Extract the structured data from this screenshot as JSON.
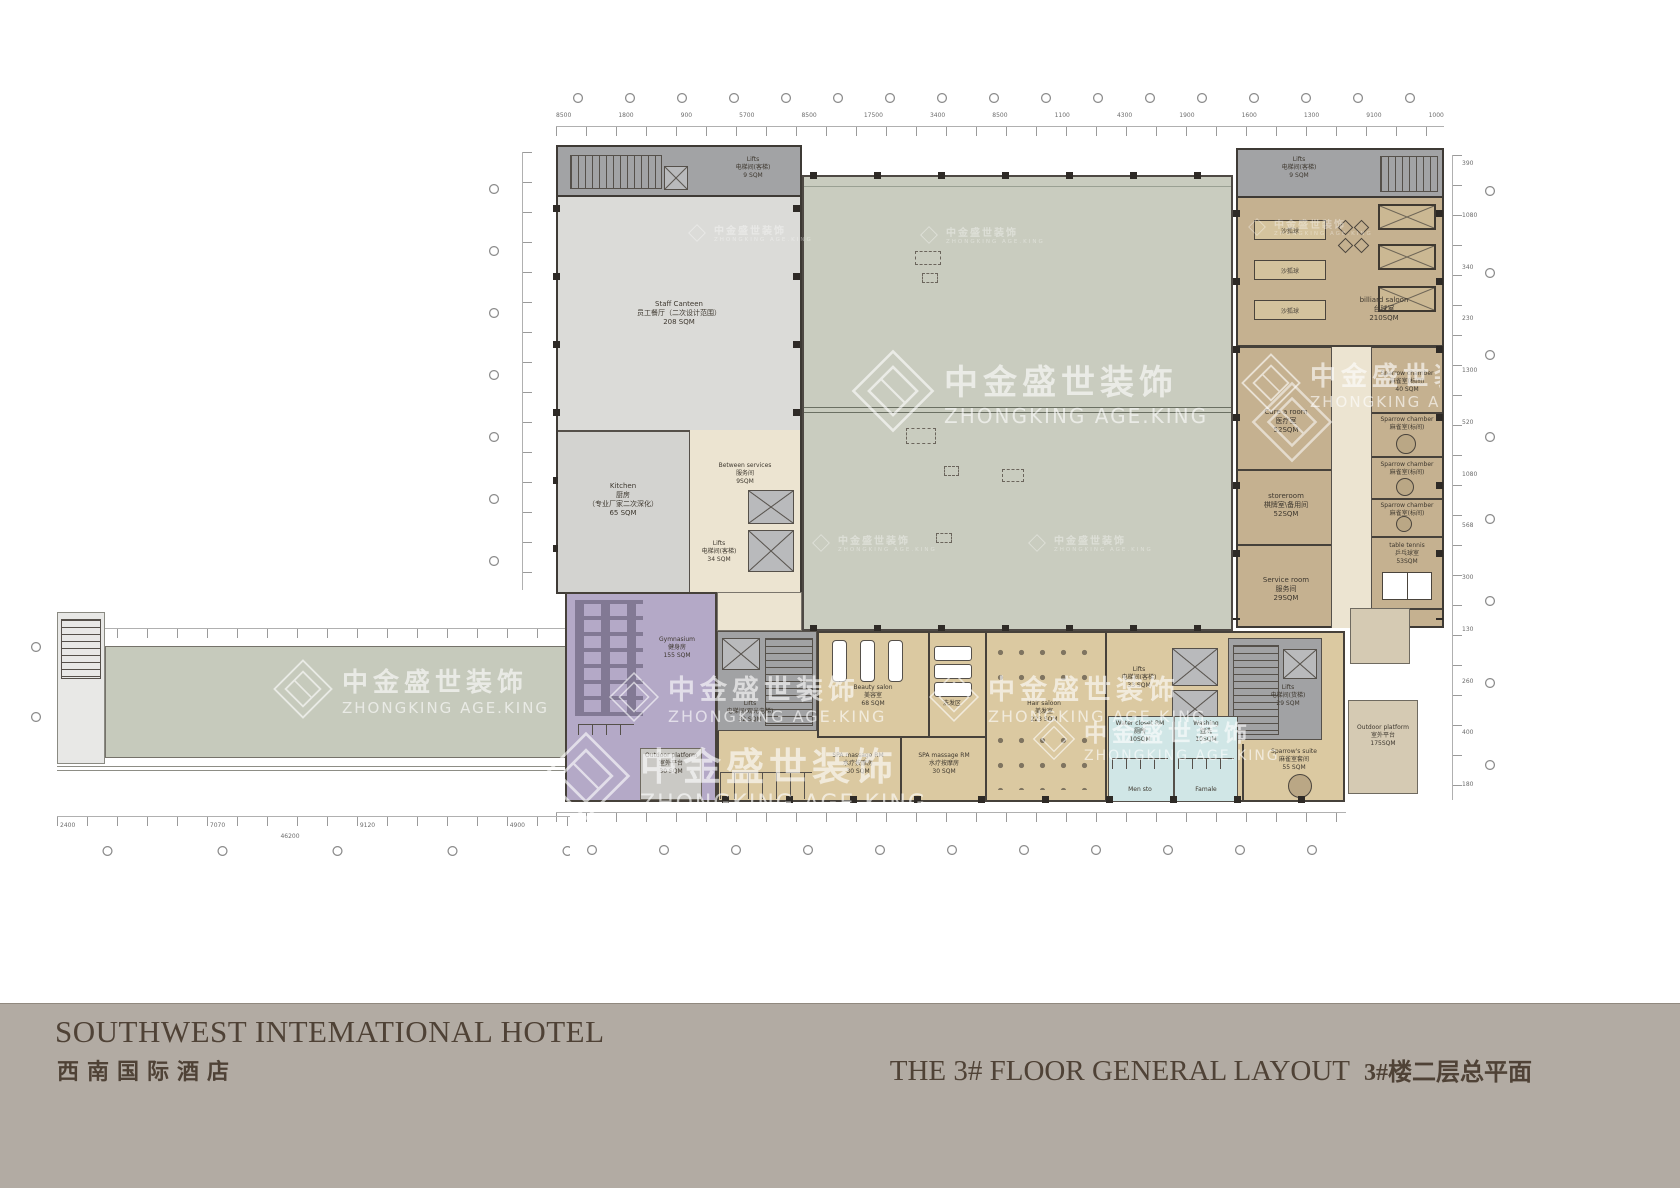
{
  "watermark": {
    "cn": "中金盛世装饰",
    "en": "ZHONGKING AGE.KING"
  },
  "footer": {
    "hotel_en": "SOUTHWEST INTEMATIONAL HOTEL",
    "hotel_cn": "西南国际酒店",
    "layout_en": "THE 3# FLOOR GENERAL LAYOUT",
    "layout_cn": "3#楼二层总平面"
  },
  "rooms": {
    "staff_canteen": {
      "en": "Staff Canteen",
      "cn": "员工餐厅（二次设计范围）",
      "area": "208 SQM"
    },
    "kitchen": {
      "en": "Kitchen",
      "cn": "厨房",
      "note": "（专业厂家二次深化）",
      "area": "65 SQM"
    },
    "between_services": {
      "en": "Between services",
      "cn": "服务间",
      "area": "9SQM"
    },
    "lifts_canteen": {
      "en": "Lifts",
      "cn": "电梯间(客梯)",
      "area": "34 SQM"
    },
    "lifts_small": {
      "en": "Lifts",
      "cn": "电梯间(客梯)",
      "area": "9 SQM"
    },
    "billiard": {
      "en": "billiard saloon",
      "cn": "台球室",
      "area": "210SQM"
    },
    "cure_room": {
      "en": "Cure a room",
      "cn": "医疗室",
      "area": "52SQM"
    },
    "storeroom": {
      "en": "storeroom",
      "cn": "棋牌室\\备用间",
      "area": "52SQM"
    },
    "service_room": {
      "en": "Service room",
      "cn": "服务间",
      "area": "29SQM"
    },
    "sparrow_chamber": {
      "en": "Sparrow chamber",
      "cn": "麻雀室(标间)",
      "area": "40 SQM"
    },
    "table_tennis": {
      "en": "table tennis",
      "cn": "乒乓球室",
      "area": "53SQM"
    },
    "lifts_freight": {
      "en": "Lifts",
      "cn": "电梯间(货梯)",
      "area": "29 SQM"
    },
    "lifts_guest": {
      "en": "Lifts",
      "cn": "电梯间(客梯)",
      "area": "33 SQM"
    },
    "lifts_sight": {
      "en": "Lifts",
      "cn": "电梯间(观光电梯)",
      "area": "32 SQM"
    },
    "beauty_salon": {
      "en": "Beauty salon",
      "cn": "美容室",
      "area": "68 SQM"
    },
    "hair_wash": {
      "cn": "洗发区"
    },
    "hair_saloon": {
      "en": "Hair saloon",
      "cn": "美发室",
      "area": "223 SQM"
    },
    "spa_massage": {
      "en": "SPA massage RM",
      "cn": "水疗按摩房",
      "area": "30 SQM"
    },
    "water_closet": {
      "en": "Water closet RM",
      "cn": "厕所",
      "area": "10SQM"
    },
    "washing": {
      "en": "Washing",
      "cn": "盥洗",
      "area": "10SQM"
    },
    "men_store": {
      "en": "Men sto",
      "cn": "男更"
    },
    "female": {
      "en": "Famale",
      "cn": "女更"
    },
    "sparrow_suite": {
      "en": "Sparrow's suite",
      "cn": "麻雀室套间",
      "area": "55 SQM"
    },
    "outdoor_platform_right": {
      "en": "Outdoor platform",
      "cn": "室外平台",
      "area": "175SQM"
    },
    "gymnasium": {
      "en": "Gymnasium",
      "cn": "健身房",
      "area": "155 SQM"
    },
    "outdoor_platform_left": {
      "en": "Outdoor platform",
      "cn": "室外平台",
      "area": "30 SQM"
    }
  },
  "furniture": {
    "shuffleboard": "沙狐球"
  },
  "dims": {
    "top": [
      "8500",
      "1800",
      "900",
      "5700",
      "8500",
      "17500",
      "3400",
      "8500",
      "1100",
      "4300",
      "1900",
      "1600",
      "1300",
      "9100",
      "1000"
    ],
    "bottom_left": [
      "2400",
      "7070",
      "9120",
      "4900"
    ],
    "bottom_left_total": "46200",
    "right": [
      "390",
      "1080",
      "340",
      "230",
      "1300",
      "520",
      "1080",
      "568",
      "300",
      "130",
      "260",
      "400",
      "180"
    ]
  },
  "colors": {
    "footer_bg": "#b2aba3",
    "wing_tan": "#c5b190",
    "band_tan": "#dbc9a1",
    "hall_green": "#c9ccbf",
    "purple": "#b4a9c7",
    "cyan": "#d0e6e6",
    "canteen_gray": "#dbdbd8",
    "core_gray": "#a1a2a4",
    "cream": "#ece4d1"
  }
}
